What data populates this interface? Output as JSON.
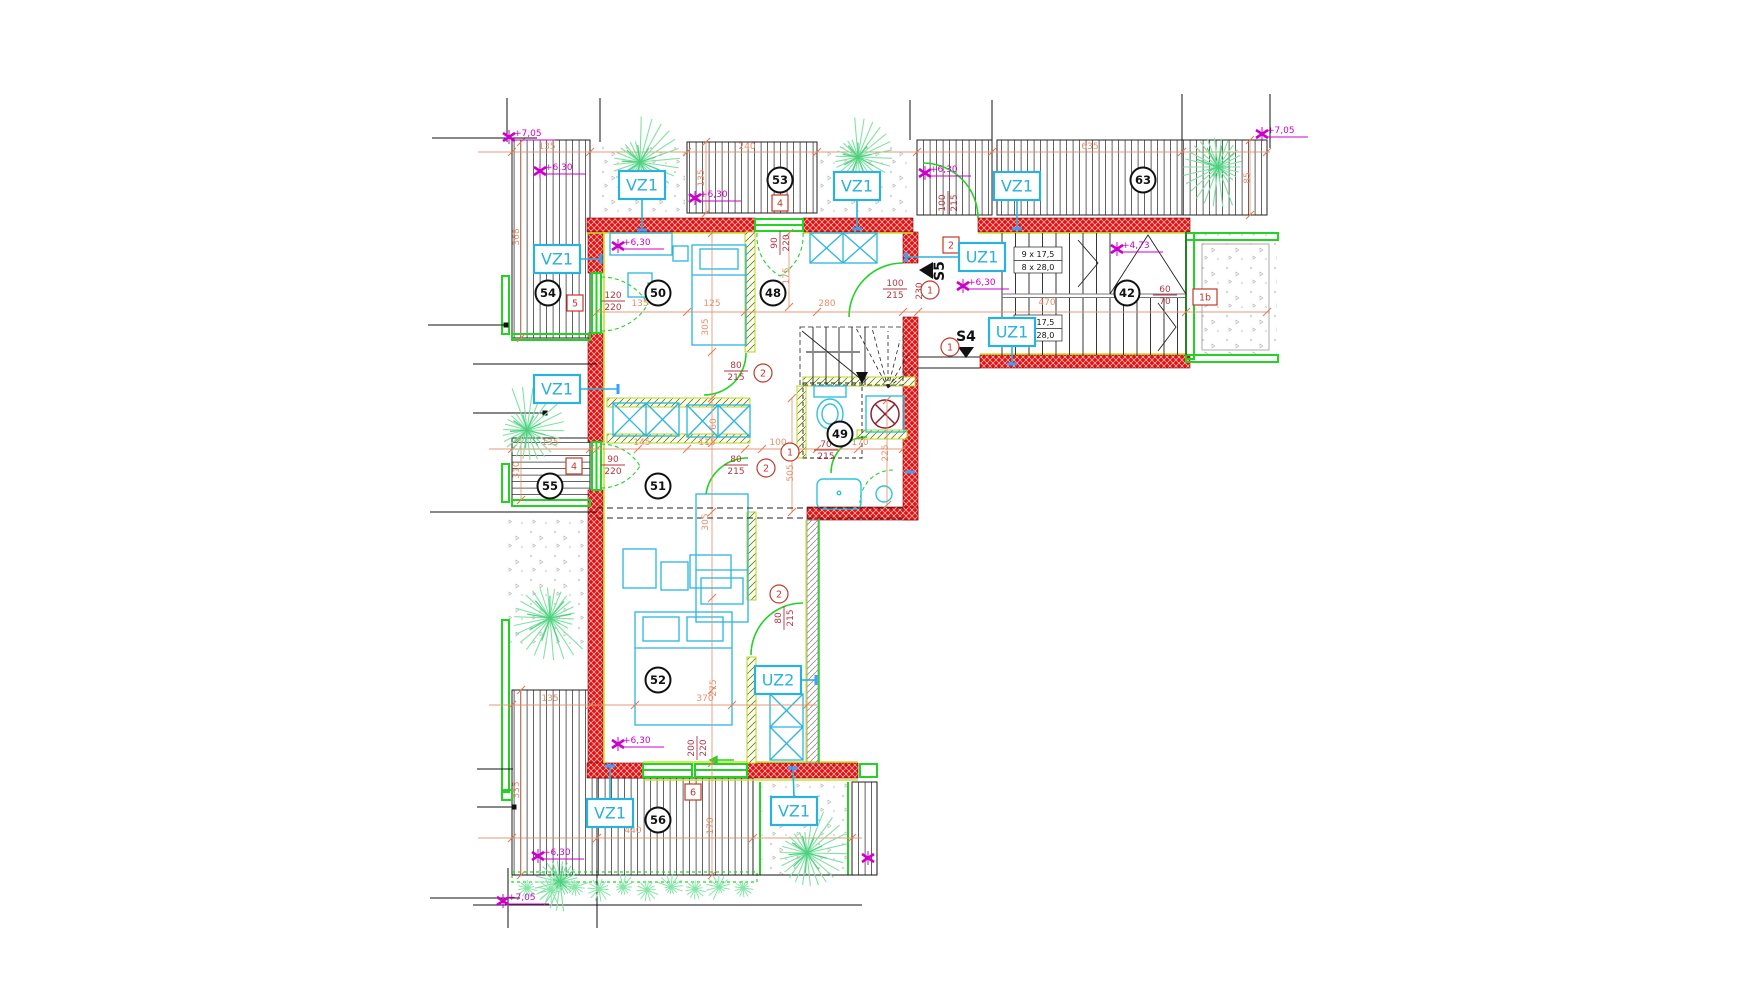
{
  "meta": {
    "drawing_type": "architectural-floor-plan"
  },
  "colors": {
    "wall_red": "#e81111",
    "dimension_salmon": "#e4906c",
    "dimension_dark_red": "#b03745",
    "tag_cyan": "#29b2dd",
    "leader_blue": "#3b9fff",
    "green": "#23d223",
    "plant_green": "#7fe2a2",
    "magenta": "#cc00cc",
    "black": "#1a1a1a"
  },
  "plan": {
    "wall_tags": [
      {
        "t": "VZ1",
        "x": 642,
        "y": 185,
        "lx": 642,
        "ly": 230
      },
      {
        "t": "VZ1",
        "x": 557,
        "y": 259,
        "lx": 601,
        "ly": 259
      },
      {
        "t": "VZ1",
        "x": 857,
        "y": 186,
        "lx": 857,
        "ly": 229
      },
      {
        "t": "VZ1",
        "x": 1017,
        "y": 186,
        "lx": 1017,
        "ly": 229
      },
      {
        "t": "VZ1",
        "x": 557,
        "y": 389,
        "lx": 618,
        "ly": 389
      },
      {
        "t": "VZ1",
        "x": 610,
        "y": 813,
        "lx": 610,
        "ly": 766
      },
      {
        "t": "VZ1",
        "x": 794,
        "y": 811,
        "lx": 793,
        "ly": 768
      },
      {
        "t": "UZ1",
        "x": 982,
        "y": 257,
        "lx": 906,
        "ly": 257
      },
      {
        "t": "UZ1",
        "x": 1012,
        "y": 332,
        "lx": 1012,
        "ly": 364
      },
      {
        "t": "UZ2",
        "x": 778,
        "y": 680,
        "lx": 816,
        "ly": 680
      }
    ],
    "room_numbers": [
      [
        "50",
        658,
        293
      ],
      [
        "48",
        773,
        293
      ],
      [
        "54",
        548,
        293
      ],
      [
        "53",
        780,
        180
      ],
      [
        "63",
        1143,
        180
      ],
      [
        "42",
        1127,
        293
      ],
      [
        "55",
        550,
        486
      ],
      [
        "51",
        658,
        486
      ],
      [
        "49",
        840,
        434
      ],
      [
        "52",
        658,
        680
      ],
      [
        "56",
        658,
        820
      ]
    ],
    "boxed_tags": [
      [
        "5",
        575,
        303
      ],
      [
        "4",
        780,
        203
      ],
      [
        "4",
        574,
        466
      ],
      [
        "2",
        951,
        245
      ],
      [
        "1b",
        1205,
        297
      ],
      [
        "6",
        693,
        792
      ]
    ],
    "circled_tags": [
      [
        "2",
        763,
        373
      ],
      [
        "2",
        766,
        468
      ],
      [
        "1",
        790,
        452
      ],
      [
        "1",
        930,
        290
      ],
      [
        "1",
        950,
        347
      ],
      [
        "2",
        779,
        594
      ]
    ],
    "elevations": [
      {
        "t": "+7,05",
        "x": 509,
        "y": 137
      },
      {
        "t": "+6,30",
        "x": 540,
        "y": 171
      },
      {
        "t": "+6,30",
        "x": 618,
        "y": 246
      },
      {
        "t": "+6,30",
        "x": 695,
        "y": 198
      },
      {
        "t": "+6,30",
        "x": 925,
        "y": 173
      },
      {
        "t": "+6,30",
        "x": 963,
        "y": 286
      },
      {
        "t": "+4,73",
        "x": 1117,
        "y": 249
      },
      {
        "t": "+7,05",
        "x": 1262,
        "y": 134
      },
      {
        "t": "+6,30",
        "x": 618,
        "y": 744
      },
      {
        "t": "+6,30",
        "x": 538,
        "y": 856
      },
      {
        "t": "+7,05",
        "x": 503,
        "y": 901
      },
      {
        "t": "",
        "x": 868,
        "y": 858
      }
    ],
    "dimensions": [
      {
        "t": "135",
        "x": 547,
        "y": 149
      },
      {
        "t": "240",
        "x": 747,
        "y": 149
      },
      {
        "t": "635",
        "x": 1090,
        "y": 149
      },
      {
        "t": "85",
        "x": 1250,
        "y": 178,
        "r": -90
      },
      {
        "t": "135",
        "x": 704,
        "y": 178,
        "r": -90
      },
      {
        "t": "368",
        "x": 519,
        "y": 237,
        "r": -90
      },
      {
        "t": "135",
        "x": 640,
        "y": 306
      },
      {
        "t": "125",
        "x": 712,
        "y": 306
      },
      {
        "t": "280",
        "x": 827,
        "y": 306
      },
      {
        "t": "470",
        "x": 1047,
        "y": 305
      },
      {
        "t": "175",
        "x": 789,
        "y": 276,
        "r": -90
      },
      {
        "t": "305",
        "x": 708,
        "y": 327,
        "r": -90
      },
      {
        "t": "135",
        "x": 550,
        "y": 445
      },
      {
        "t": "145",
        "x": 642,
        "y": 445
      },
      {
        "t": "115",
        "x": 707,
        "y": 445
      },
      {
        "t": "100",
        "x": 778,
        "y": 445
      },
      {
        "t": "170",
        "x": 860,
        "y": 445
      },
      {
        "t": "225",
        "x": 888,
        "y": 453,
        "r": -90
      },
      {
        "t": "505",
        "x": 793,
        "y": 473,
        "r": -90
      },
      {
        "t": "60",
        "x": 716,
        "y": 424,
        "r": -90
      },
      {
        "t": "310",
        "x": 519,
        "y": 470,
        "r": -90
      },
      {
        "t": "305",
        "x": 708,
        "y": 522,
        "r": -90
      },
      {
        "t": "275",
        "x": 716,
        "y": 688,
        "r": -90
      },
      {
        "t": "370",
        "x": 705,
        "y": 701
      },
      {
        "t": "135",
        "x": 550,
        "y": 701
      },
      {
        "t": "335",
        "x": 519,
        "y": 790,
        "r": -90
      },
      {
        "t": "440",
        "x": 633,
        "y": 833
      },
      {
        "t": "178",
        "x": 713,
        "y": 826,
        "r": -90
      },
      {
        "t": "230",
        "x": 922,
        "y": 291,
        "r": -90,
        "dark": true
      }
    ],
    "fractions": [
      {
        "n": "120",
        "d": "220",
        "x": 613,
        "y": 300
      },
      {
        "n": "90",
        "d": "220",
        "x": 779,
        "y": 243,
        "r": -90
      },
      {
        "n": "100",
        "d": "215",
        "x": 947,
        "y": 203,
        "r": -90
      },
      {
        "n": "100",
        "d": "215",
        "x": 895,
        "y": 288
      },
      {
        "n": "80",
        "d": "215",
        "x": 736,
        "y": 370
      },
      {
        "n": "90",
        "d": "220",
        "x": 613,
        "y": 464
      },
      {
        "n": "80",
        "d": "215",
        "x": 736,
        "y": 464
      },
      {
        "n": "70",
        "d": "215",
        "x": 826,
        "y": 449
      },
      {
        "n": "60",
        "d": "70",
        "x": 1165,
        "y": 294
      },
      {
        "n": "80",
        "d": "215",
        "x": 783,
        "y": 618,
        "r": -90
      },
      {
        "n": "200",
        "d": "220",
        "x": 696,
        "y": 748,
        "r": -90
      }
    ],
    "stair_notes": [
      [
        "9 x 17,5",
        1038,
        257
      ],
      [
        "8 x 28,0",
        1038,
        270
      ],
      [
        "9 x 17,5",
        1038,
        325
      ],
      [
        "8 x 28,0",
        1038,
        338
      ]
    ],
    "sections": [
      {
        "t": "S5",
        "x": 944,
        "y": 271,
        "r": -90,
        "tri": [
          [
            933,
            262
          ],
          [
            933,
            279
          ],
          [
            919,
            270
          ]
        ]
      },
      {
        "t": "S4",
        "x": 966,
        "y": 341,
        "r": 0,
        "tri": [
          [
            958,
            347
          ],
          [
            974,
            347
          ],
          [
            966,
            358
          ]
        ]
      }
    ],
    "dim_lines": [
      {
        "x1": 478,
        "y1": 152,
        "x2": 1270,
        "y2": 152,
        "tx": [
          512,
          590,
          687,
          817,
          917,
          992,
          1182,
          1267
        ]
      },
      {
        "x1": 597,
        "y1": 312,
        "x2": 1270,
        "y2": 312,
        "tx": [
          597,
          687,
          745,
          817,
          903,
          918,
          1186,
          1267
        ]
      },
      {
        "x1": 489,
        "y1": 449,
        "x2": 903,
        "y2": 449,
        "tx": [
          512,
          590,
          597,
          638,
          687,
          745,
          762,
          790,
          817,
          858,
          903
        ]
      },
      {
        "x1": 489,
        "y1": 705,
        "x2": 817,
        "y2": 705,
        "tx": [
          512,
          590,
          597,
          635,
          732,
          807
        ]
      },
      {
        "x1": 478,
        "y1": 838,
        "x2": 862,
        "y2": 838,
        "tx": [
          512,
          597,
          753,
          852
        ]
      },
      {
        "x1": 712,
        "y1": 233,
        "x2": 712,
        "y2": 875,
        "ty": [
          233,
          352,
          398,
          443,
          512,
          598,
          690,
          763,
          875
        ]
      },
      {
        "x1": 521,
        "y1": 142,
        "x2": 521,
        "y2": 338,
        "ty": [
          142,
          338
        ]
      },
      {
        "x1": 521,
        "y1": 438,
        "x2": 521,
        "y2": 500,
        "ty": [
          438,
          500
        ]
      },
      {
        "x1": 521,
        "y1": 690,
        "x2": 521,
        "y2": 875,
        "ty": [
          690,
          875
        ]
      },
      {
        "x1": 792,
        "y1": 398,
        "x2": 792,
        "y2": 512,
        "ty": [
          398,
          512
        ]
      },
      {
        "x1": 887,
        "y1": 400,
        "x2": 887,
        "y2": 505,
        "ty": [
          400,
          505
        ]
      },
      {
        "x1": 1250,
        "y1": 140,
        "x2": 1250,
        "y2": 215,
        "ty": [
          140,
          215
        ]
      },
      {
        "x1": 706,
        "y1": 142,
        "x2": 706,
        "y2": 213,
        "ty": [
          142,
          213
        ]
      },
      {
        "x1": 789,
        "y1": 233,
        "x2": 789,
        "y2": 307,
        "ty": [
          233,
          307
        ]
      }
    ],
    "datum_lines": [
      {
        "x1": 432,
        "y1": 138,
        "x2": 537,
        "y2": 138
      },
      {
        "x1": 428,
        "y1": 325,
        "x2": 506,
        "y2": 325,
        "dot": 1
      },
      {
        "x1": 473,
        "y1": 364,
        "x2": 597,
        "y2": 364
      },
      {
        "x1": 473,
        "y1": 413,
        "x2": 545,
        "y2": 413,
        "dot": 1
      },
      {
        "x1": 430,
        "y1": 512,
        "x2": 597,
        "y2": 512
      },
      {
        "x1": 477,
        "y1": 769,
        "x2": 513,
        "y2": 769
      },
      {
        "x1": 477,
        "y1": 807,
        "x2": 514,
        "y2": 807,
        "dot": 1
      },
      {
        "x1": 430,
        "y1": 898,
        "x2": 520,
        "y2": 898
      },
      {
        "x1": 507,
        "y1": 98,
        "x2": 507,
        "y2": 142
      },
      {
        "x1": 600,
        "y1": 98,
        "x2": 600,
        "y2": 142
      },
      {
        "x1": 910,
        "y1": 100,
        "x2": 910,
        "y2": 140
      },
      {
        "x1": 992,
        "y1": 100,
        "x2": 992,
        "y2": 140
      },
      {
        "x1": 1182,
        "y1": 94,
        "x2": 1182,
        "y2": 140
      },
      {
        "x1": 1270,
        "y1": 94,
        "x2": 1270,
        "y2": 148
      },
      {
        "x1": 508,
        "y1": 868,
        "x2": 508,
        "y2": 928
      },
      {
        "x1": 597,
        "y1": 868,
        "x2": 597,
        "y2": 928
      },
      {
        "x1": 473,
        "y1": 905,
        "x2": 862,
        "y2": 905
      }
    ],
    "dashed_lines": [
      {
        "x1": 597,
        "y1": 508,
        "x2": 907,
        "y2": 508
      },
      {
        "x1": 597,
        "y1": 518,
        "x2": 907,
        "y2": 518
      }
    ],
    "plants": [
      [
        640,
        162,
        46
      ],
      [
        858,
        157,
        40
      ],
      [
        1218,
        167,
        42
      ],
      [
        527,
        430,
        45
      ],
      [
        550,
        618,
        46
      ],
      [
        807,
        853,
        46
      ],
      [
        560,
        882,
        30
      ]
    ],
    "shrubs": [
      [
        527,
        888
      ],
      [
        551,
        890
      ],
      [
        575,
        887
      ],
      [
        599,
        889
      ],
      [
        623,
        887
      ],
      [
        647,
        890
      ],
      [
        671,
        887
      ],
      [
        695,
        889
      ],
      [
        719,
        887
      ],
      [
        743,
        888
      ]
    ],
    "blue_ticks": [
      [
        910,
        472
      ]
    ]
  }
}
